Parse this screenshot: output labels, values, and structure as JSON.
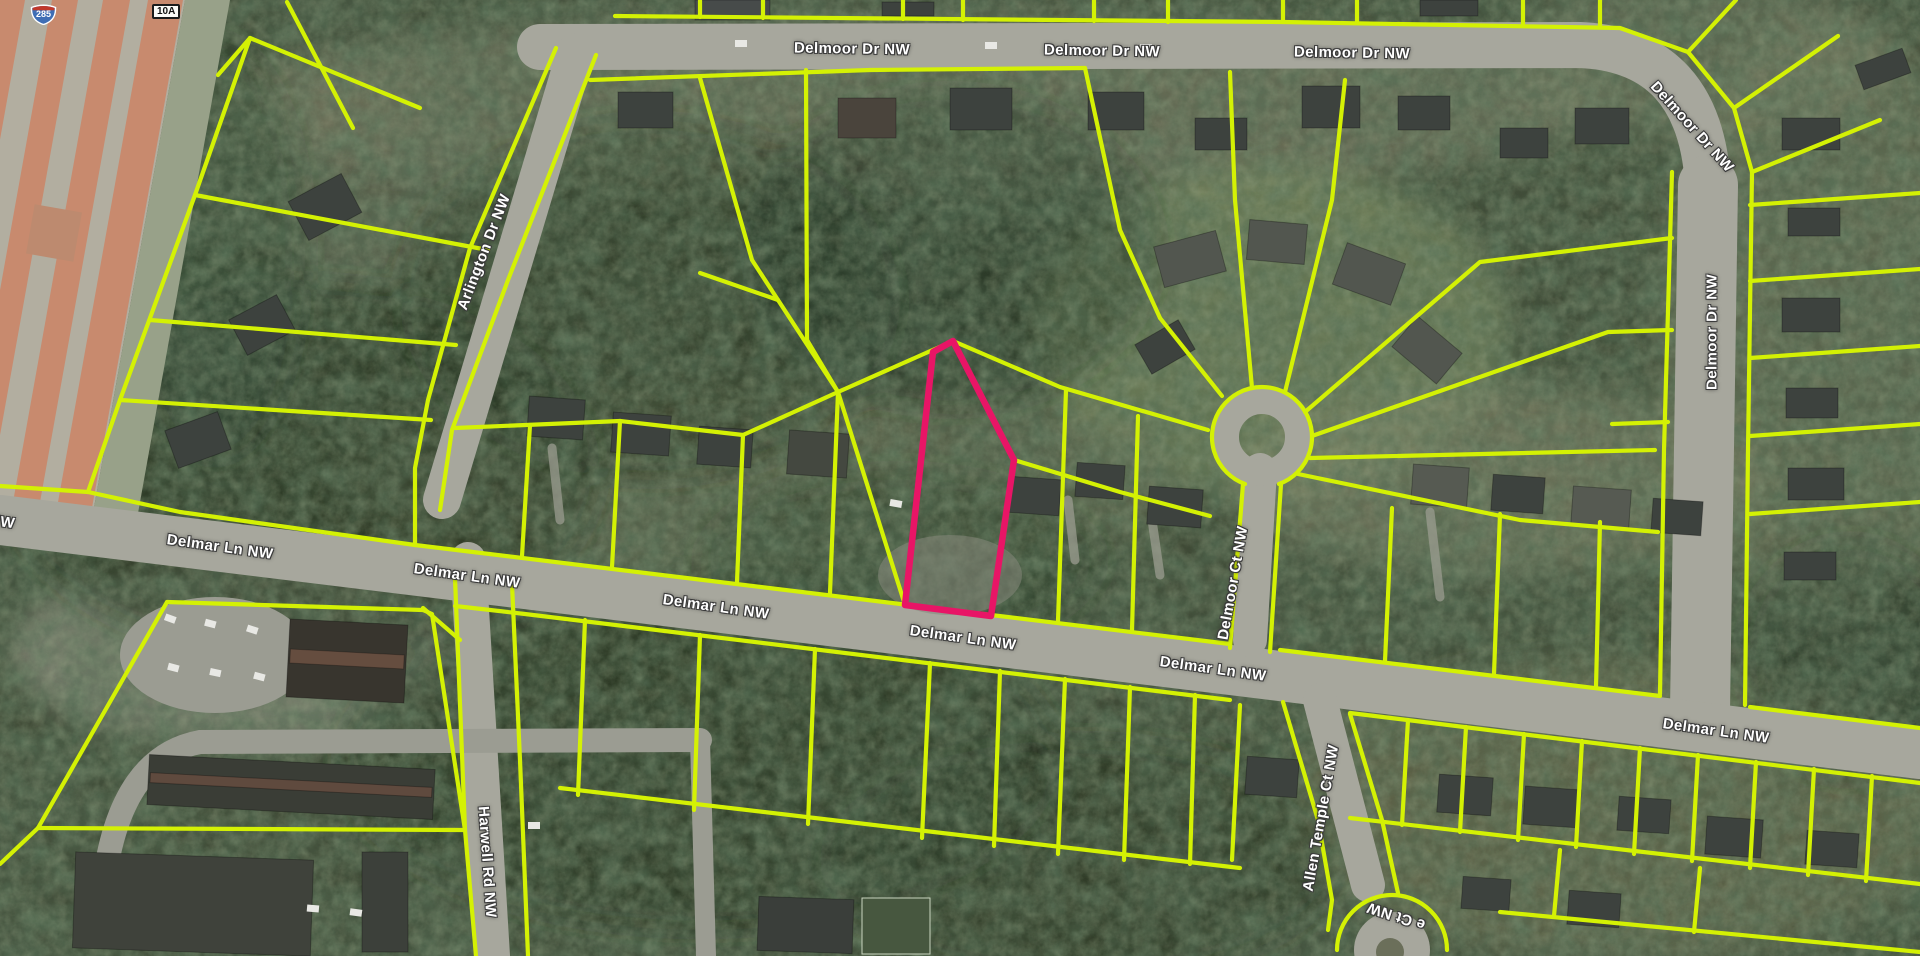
{
  "map": {
    "type": "aerial-parcel-view",
    "colors": {
      "parcel_line": "#d4f104",
      "selected_parcel": "#e81566",
      "label_fill": "#ffffff",
      "label_outline": "#3a3a3a",
      "highway_lane": "#c88a6e",
      "road_surface": "#a7a79d"
    },
    "highway_shield": {
      "system": "interstate",
      "number": "285"
    },
    "exit_badge": "10A",
    "selected_parcel": {
      "points": "953,341 1014,460 991,616 905,605 933,352"
    },
    "labels": [
      {
        "text": "Delmoor Dr NW",
        "x": 852,
        "y": 49,
        "rot": 1
      },
      {
        "text": "Delmoor Dr NW",
        "x": 1102,
        "y": 51,
        "rot": 1
      },
      {
        "text": "Delmoor Dr NW",
        "x": 1352,
        "y": 53,
        "rot": 1
      },
      {
        "text": "Delmoor Dr NW",
        "x": 1692,
        "y": 127,
        "rot": 48
      },
      {
        "text": "Delmoor Dr NW",
        "x": 1712,
        "y": 332,
        "rot": -90
      },
      {
        "text": "Arlington Dr NW",
        "x": 484,
        "y": 252,
        "rot": -69
      },
      {
        "text": "NW",
        "x": 2,
        "y": 522,
        "rot": 8
      },
      {
        "text": "Delmar Ln NW",
        "x": 220,
        "y": 547,
        "rot": 8
      },
      {
        "text": "Delmar Ln NW",
        "x": 467,
        "y": 576,
        "rot": 8
      },
      {
        "text": "Delmar Ln NW",
        "x": 716,
        "y": 607,
        "rot": 8
      },
      {
        "text": "Delmar Ln NW",
        "x": 963,
        "y": 638,
        "rot": 8
      },
      {
        "text": "Delmar Ln NW",
        "x": 1213,
        "y": 669,
        "rot": 8
      },
      {
        "text": "Delmar Ln NW",
        "x": 1716,
        "y": 731,
        "rot": 8
      },
      {
        "text": "Delmoor Ct NW",
        "x": 1233,
        "y": 583,
        "rot": -80
      },
      {
        "text": "Allen Temple Ct NW",
        "x": 1321,
        "y": 818,
        "rot": -80
      },
      {
        "text": "Harwell Rd NW",
        "x": 487,
        "y": 862,
        "rot": 86
      },
      {
        "text": "e Ct NW",
        "x": 1396,
        "y": 916,
        "rot": 198
      }
    ],
    "parcel_lines": [
      "250,38 420,108",
      "250,38 195,195 120,400 88,492",
      "287,2 353,128",
      "218,75 250,38",
      "195,195 488,250",
      "150,320 456,345",
      "120,400 431,420",
      "0,486 88,492 180,512 415,545",
      "556,48 470,248 428,400 415,468 415,545",
      "596,55 508,280 452,430 440,510",
      "590,80 870,70 1085,68",
      "700,78 752,260 778,300 838,392",
      "700,273 778,300",
      "806,70 807,340 838,392",
      "838,392 953,341",
      "953,341 1060,387 1208,430",
      "838,392 743,435",
      "455,428 620,421 743,435",
      "743,435 737,582",
      "838,392 830,593",
      "838,392 905,605",
      "530,425 522,556",
      "620,421 612,567",
      "1014,460 1120,492 1210,516",
      "1066,390 1058,621",
      "1138,416 1132,630",
      "1085,68 1120,230 1160,318",
      "1222,396 1160,318",
      "1252,388 1235,200 1230,72",
      "1285,392 1332,200 1345,80",
      "1305,412 1480,262 1672,238",
      "1312,436 1608,332 1672,330",
      "1310,458 1655,450",
      "1298,474 1520,520 1658,532",
      "1392,508 1385,661",
      "1500,514 1494,674",
      "1600,522 1596,687",
      "1243,484 1230,648",
      "1281,484 1270,652",
      "615,16 1283,22 1620,28 1688,52 1734,108 1752,172",
      "1672,172 1664,450 1660,694",
      "1752,172 1748,450 1745,705",
      "1688,52 1736,0",
      "1734,108 1838,36",
      "1752,172 1880,120",
      "1750,205 1920,193",
      "1750,281 1920,269",
      "1750,358 1920,346",
      "1750,436 1920,424",
      "1750,514 1920,502",
      "1612,424 1668,422",
      "415,545 1230,644",
      "1280,650 1660,696",
      "1750,707 1920,728",
      "455,606 525,614 1230,700",
      "1350,713 1920,783",
      "560,788 1240,868",
      "1350,818 1920,884",
      "1500,912 1920,952",
      "585,620 578,795",
      "700,635 694,810",
      "815,649 808,824",
      "930,663 922,838",
      "1000,671 994,846",
      "1065,679 1058,854",
      "1130,687 1124,860",
      "1195,695 1190,864",
      "1408,720 1402,825",
      "1466,727 1460,832",
      "1524,734 1518,840",
      "1582,741 1576,847",
      "1640,748 1634,854",
      "1698,755 1692,861",
      "1756,762 1750,868",
      "1814,769 1808,875",
      "1872,776 1866,881",
      "1560,850 1554,916",
      "1700,868 1694,932",
      "455,578 465,830 476,956",
      "512,584 520,760 528,956",
      "167,602 423,610",
      "167,602 38,828",
      "38,828 465,830",
      "0,864 38,828",
      "423,610 432,614 465,830",
      "1283,702 1318,820 1332,900 1328,930",
      "1350,714 1382,820 1398,893",
      "1240,705 1232,860",
      "423,608 460,640",
      "700,0 700,17",
      "763,0 763,18",
      "903,0 903,19",
      "963,0 963,20",
      "1094,0 1094,21",
      "1168,0 1168,22",
      "1283,0 1283,22",
      "1357,0 1357,23",
      "1523,0 1523,26",
      "1600,0 1600,27"
    ],
    "parcel_arcs": [
      "M 1245 484 A 50 50 0 1 1 1279 484",
      "M 1337 950 A 55 55 0 0 1 1447 950"
    ]
  }
}
